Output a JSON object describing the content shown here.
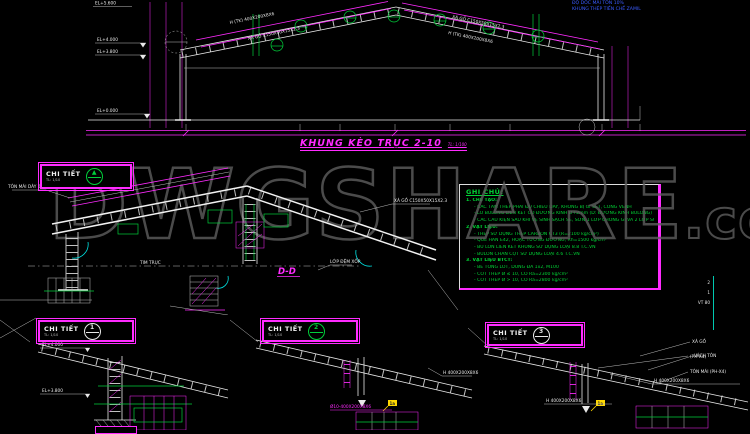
{
  "watermark": {
    "text": "DWGSHARE",
    "suffix": ".com"
  },
  "top_right": {
    "line1": "ĐỘ DỐC MÁI TÔN 10%",
    "line2": "KHUNG THÉP TIỀN CHẾ ZAMIL"
  },
  "elevation": {
    "title": "KHUNG KÈO TRỤC 2-10",
    "scale": "TL: 1/100",
    "level_apex": "EL+5.600",
    "level_eave_top": "EL+4.000",
    "level_eave_bot": "EL+3.800",
    "level_ground": "EL+0.000",
    "rafter_label_left": "H (TK) 400X200X8X6",
    "purlin_label_left": "XÀ GỒ C150X50X15X2.3",
    "rafter_label_right": "H (TK) 400X200X8X6",
    "purlin_label_right": "XÀ GỒ C150X50X15X2.3"
  },
  "notes": {
    "title": "GHI CHÚ:",
    "lines": [
      "1. CHẾ TẠO:",
      "- CÁC TẤM THÉP PHẢI ĐỦ CHIỀU DÀY, KHÔNG BỊ GỈ SÉT, CONG VÊNH",
      "- LỖ BULONG LIÊN KẾT CÓ ĐƯỜNG KÍNH D+2mm (D: ĐƯỜNG KÍNH BULONG)",
      "- CÁC CẤU KIỆN SAU KHI VỆ SINH SẠCH SẼ, SƠN 1 LỚP CHỐNG GỈ VÀ 2 LỚP SƠN MÀU",
      "2. VẬT LIỆU:",
      "- THÉP SỬ DỤNG THÉP CARBON CT3 (R=2100 kg/cm²)",
      "- QUE HÀN E42, HOẶC TƯƠNG ĐƯƠNG, Rh=1500 kg/cm²",
      "- BU LON LIÊN KẾT KHUNG SỬ DỤNG LOẠI 8.8 T.C.VN",
      "- BULON CHÂN CỘT SỬ DỤNG LOẠI 4.6 T.C.VN",
      "3. VẬT LIỆU BTCT:",
      "- BÊ TÔNG LÓT, DÙNG ĐÁ 1x2, M100",
      "- CỐT THÉP Ø ≤ 10, CÓ Ra=2300 kg/cm²",
      "- CỐT THÉP Ø > 10, CÓ Ra=2800 kg/cm²"
    ]
  },
  "detail_main": {
    "stamp": "CHI TIẾT",
    "stamp_scale": "TL: 1/10",
    "stamp_mark": "▲",
    "section_label": "D-D",
    "leader_purlin": "XÀ GỒ C150X50X15X2.3",
    "leader_roof": "TÔN MÁI DÀY 0.45mm",
    "leader_pad": "LỚP ĐỆM XỐP",
    "axis_label": "TIM TRỤC"
  },
  "detail_1": {
    "stamp": "CHI TIẾT",
    "num": "1",
    "scale": "TL: 1/10",
    "level_top": "EL+4.000",
    "level_bot": "EL+3.800"
  },
  "detail_2": {
    "stamp": "CHI TIẾT",
    "num": "2",
    "scale": "TL: 1/10",
    "beam_label": "H 400X200X8X6",
    "plate_label": "Ø10-400X200X8X6",
    "flag": "1a"
  },
  "detail_3": {
    "stamp": "CHI TIẾT",
    "num": "3",
    "scale": "TL: 1/10",
    "beam_label": "H 400X200X8X6",
    "beam_label2": "H 400X200X8X6",
    "ref": "(PH-X4)",
    "flag": "1a",
    "leader_1": "XÀ GỒ",
    "leader_2": "VÁCH TÔN",
    "leader_3": "TÔN MÁI (PH-X4)",
    "mark_1": "2",
    "mark_2": "1",
    "mark_3": "VT 80"
  },
  "colors": {
    "accent_magenta": "#ff2bff",
    "note_green": "#00d435",
    "cyan": "#00e0e0",
    "link_blue": "#3a5bff"
  }
}
